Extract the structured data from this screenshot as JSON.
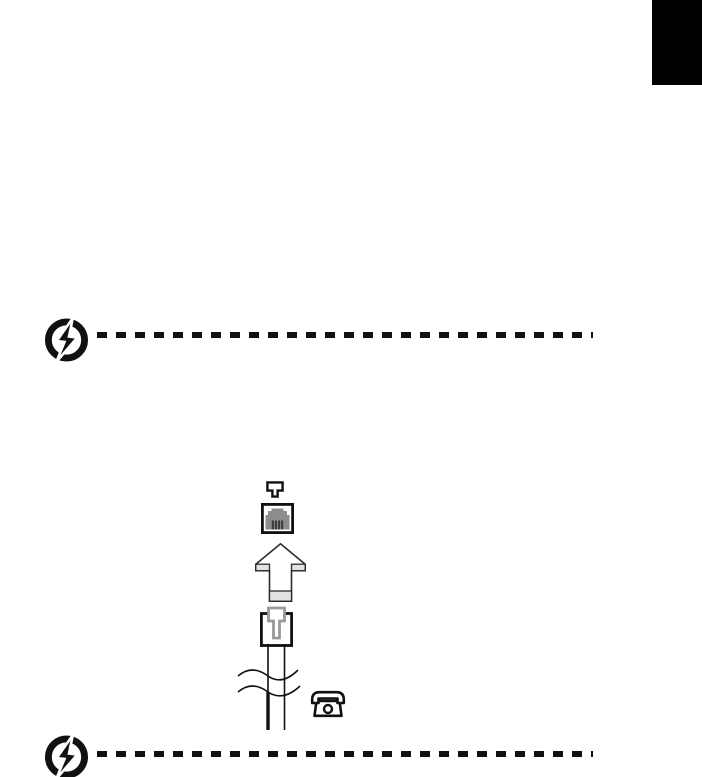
{
  "page": {
    "background": "#ffffff"
  },
  "colors": {
    "page_bg": "#ffffff",
    "ink": "#111111",
    "tab_black": "#000000",
    "outline": "#2b2b2b",
    "socket_gray": "#8d8d8d",
    "pin_dark": "#3c3c3c",
    "shade_gray": "#e2e2e2",
    "clip_gray": "#9a9a9a"
  },
  "language_tab": {
    "icon": "black-language-tab"
  },
  "warning_top": {
    "icon": "lightning-warning-icon",
    "divider": "dashed-line"
  },
  "figure": {
    "icons": [
      "phone-line-jack-symbol-icon",
      "rj11-modem-port-icon",
      "up-arrow-icon",
      "rj11-plug-icon",
      "cable-break-waves-icon",
      "telephone-icon"
    ]
  },
  "warning_bottom": {
    "icon": "lightning-warning-icon",
    "divider": "dashed-line"
  }
}
